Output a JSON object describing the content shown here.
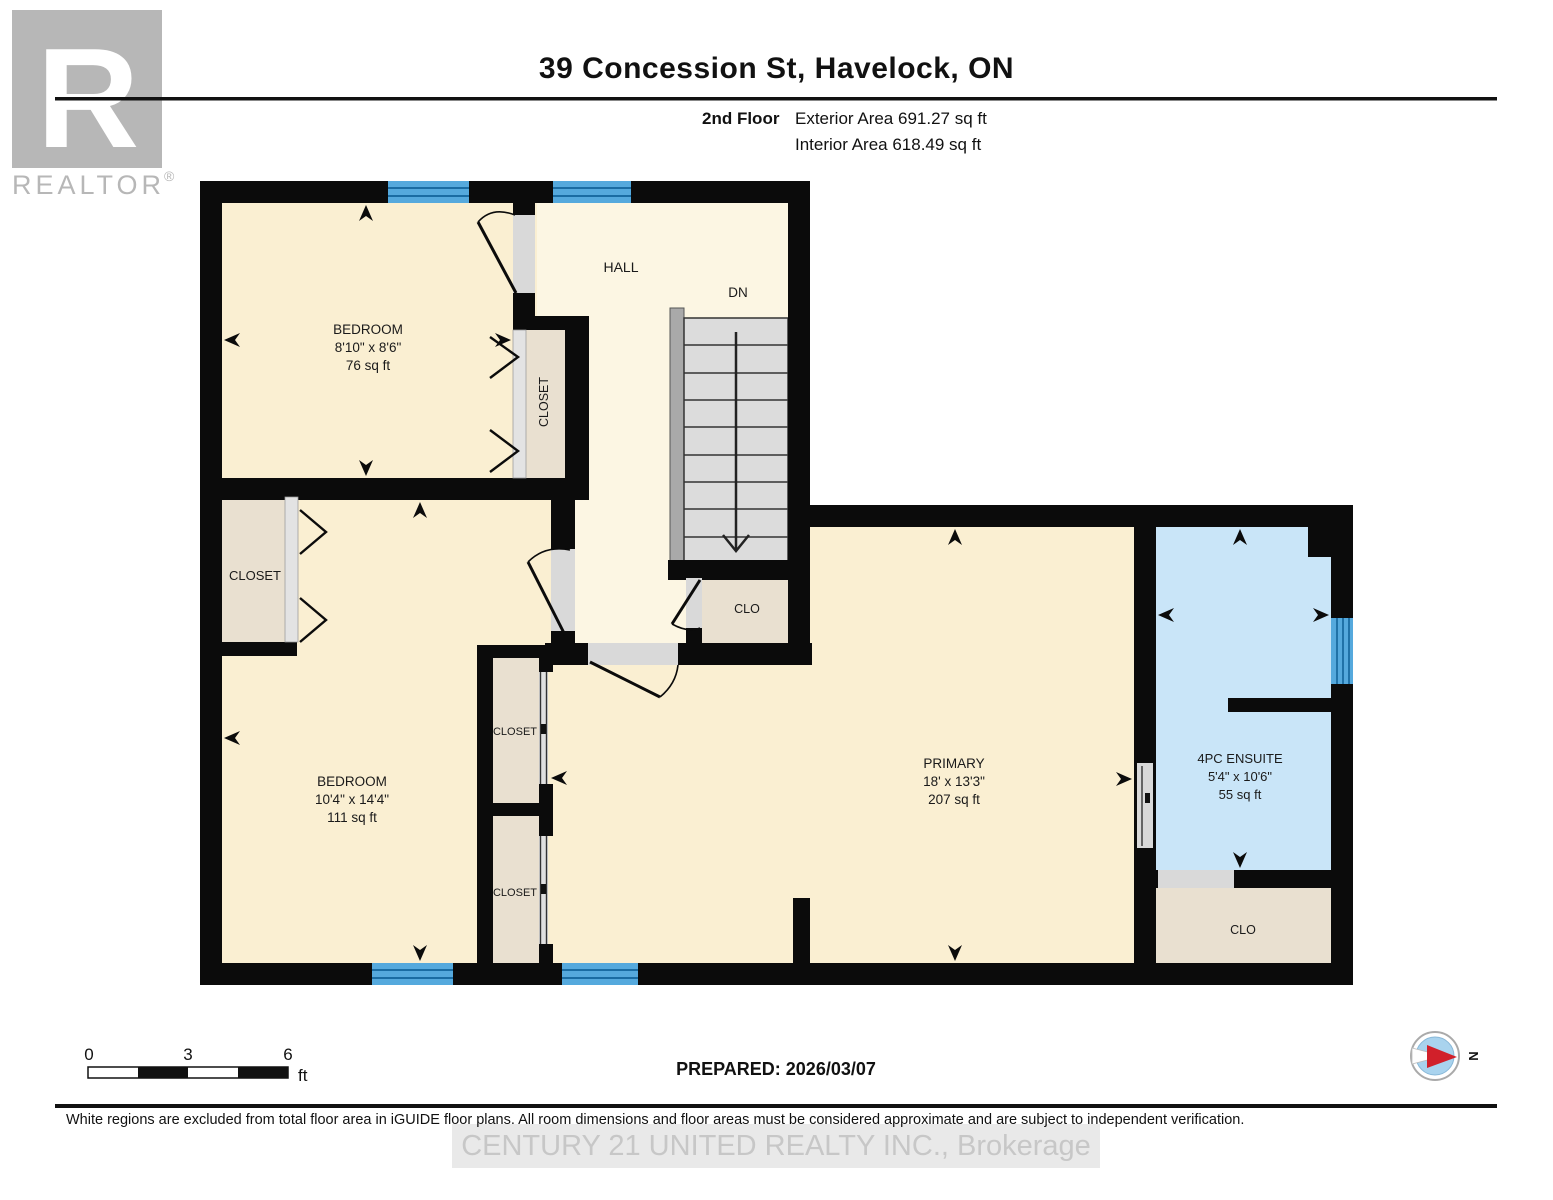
{
  "header": {
    "title": "39 Concession St, Havelock, ON",
    "floor_label": "2nd Floor",
    "exterior_area": "Exterior Area 691.27 sq ft",
    "interior_area": "Interior Area 618.49 sq ft"
  },
  "logo": {
    "letter": "R",
    "name": "REALTOR",
    "registered": "®"
  },
  "plan": {
    "bedroom1": {
      "name": "BEDROOM",
      "dims": "8'10\" x 8'6\"",
      "area": "76 sq ft"
    },
    "hall": {
      "name": "HALL"
    },
    "stairs": {
      "direction": "DN"
    },
    "closet_bedroom1": {
      "name": "CLOSET"
    },
    "closet_bedroom2": {
      "name": "CLOSET"
    },
    "bedroom2": {
      "name": "BEDROOM",
      "dims": "10'4\" x 14'4\"",
      "area": "111 sq ft"
    },
    "closet_mid_upper": {
      "name": "CLOSET"
    },
    "closet_mid_lower": {
      "name": "CLOSET"
    },
    "closet_hall": {
      "name": "CLO"
    },
    "primary": {
      "name": "PRIMARY",
      "dims": "18' x 13'3\"",
      "area": "207 sq ft"
    },
    "ensuite": {
      "name": "4PC ENSUITE",
      "dims": "5'4\" x 10'6\"",
      "area": "55 sq ft"
    },
    "closet_ensuite": {
      "name": "CLO"
    }
  },
  "scale_bar": {
    "start": "0",
    "mid": "3",
    "end": "6",
    "unit": "ft"
  },
  "prepared": "PREPARED: 2026/03/07",
  "compass": {
    "north": "N"
  },
  "footer": {
    "disclaimer": "White regions are excluded from total floor area in iGUIDE floor plans. All room dimensions and floor areas must be considered approximate and are subject to independent verification.",
    "watermark": "CENTURY 21 UNITED REALTY INC., Brokerage"
  },
  "colors": {
    "wall": "#0b0b0b",
    "room_cream": "#faefd2",
    "hall_cream": "#fcf6e3",
    "closet_tan": "#e9e0d0",
    "ensuite_blue": "#c9e5f8",
    "window_blue": "#55a9dd",
    "window_line": "#1a6ca3",
    "stair_gray": "#dcdcdc",
    "railing_gray": "#a9a9a9",
    "door_gray": "#d9d9d9",
    "compass_red": "#d1202a",
    "logo_gray": "#b7b7b7"
  }
}
